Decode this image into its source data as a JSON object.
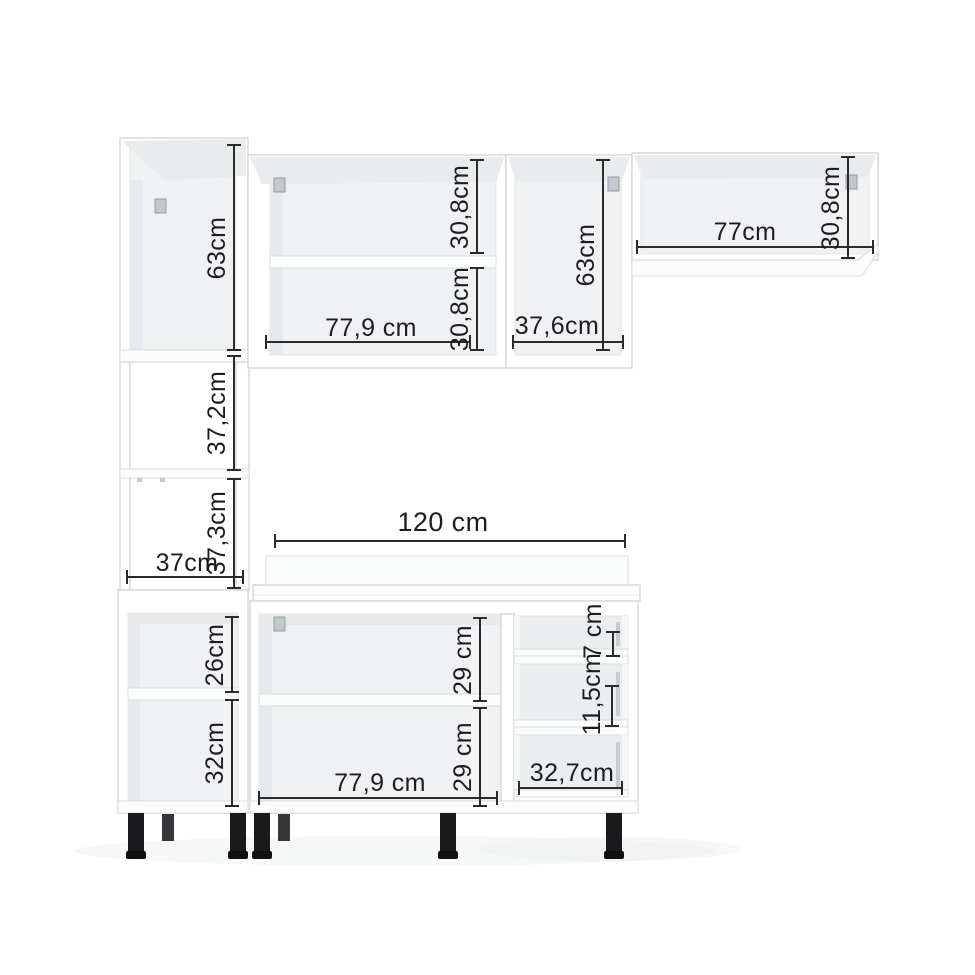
{
  "diagram": {
    "kind": "kitchen-cabinet-set-dimension-diagram",
    "background": "#ffffff",
    "dimension_line_color": "#2b2b2b",
    "text_color": "#1d1d1f",
    "cabinet_fill": "#ffffff",
    "cabinet_outline": "#d5d8da",
    "interior_fill": "#eff1f2",
    "leg_color": "#1a1a1c",
    "hinge_color": "#c3c8cc"
  },
  "dimensions": {
    "tower": {
      "upper_height": "63cm",
      "niche_upper_height": "37,2cm",
      "niche_lower_height": "37,3cm",
      "width": "37cm"
    },
    "wall_cabinet_left": {
      "width": "77,9 cm",
      "upper_section_height": "30,8cm",
      "lower_section_height": "30,8cm"
    },
    "wall_cabinet_middle": {
      "width": "37,6cm",
      "height": "63cm"
    },
    "wall_shelf_right": {
      "width": "77cm",
      "height": "30,8cm"
    },
    "counter": {
      "width": "120 cm"
    },
    "base_tower": {
      "upper_section_height": "26cm",
      "lower_section_height": "32cm"
    },
    "base_cabinet": {
      "width": "77,9 cm",
      "upper_section_height": "29 cm",
      "lower_section_height": "29 cm"
    },
    "drawers": {
      "top_height": "7 cm",
      "middle_height": "11,5cm",
      "width": "32,7cm"
    }
  }
}
